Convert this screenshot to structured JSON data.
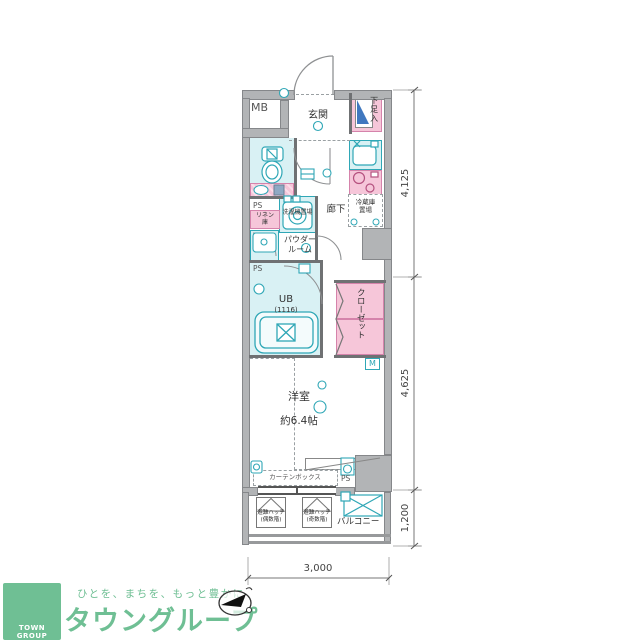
{
  "plan": {
    "labels": {
      "mb": "MB",
      "genkan": "玄関",
      "shoe_box": "下足入",
      "hallway": "廊下",
      "fridge_line1": "冷蔵庫",
      "fridge_line2": "置場",
      "ps": "PS",
      "linen_line1": "リネン",
      "linen_line2": "庫",
      "washer": "洗濯機置場",
      "powder_line1": "パウダー",
      "powder_line2": "ルーム",
      "unit_bath": "UB",
      "unit_bath_size": "(1116)",
      "closet": "クローゼット",
      "meter": "M",
      "room": "洋室",
      "room_size": "約6.4帖",
      "curtain_box": "カーテンボックス",
      "hatch": "避難ハッチ",
      "hatch_even": "(偶数階)",
      "hatch_odd": "(奇数階)",
      "balcony": "バルコニー"
    },
    "dimensions": {
      "right_top": "4,125",
      "right_middle": "4,625",
      "right_bottom": "1,200",
      "bottom": "3,000"
    }
  },
  "logo": {
    "tagline": "ひとを、まちを、もっと豊かに",
    "company": "タウングループ",
    "badge": "TOWN GROUP"
  }
}
